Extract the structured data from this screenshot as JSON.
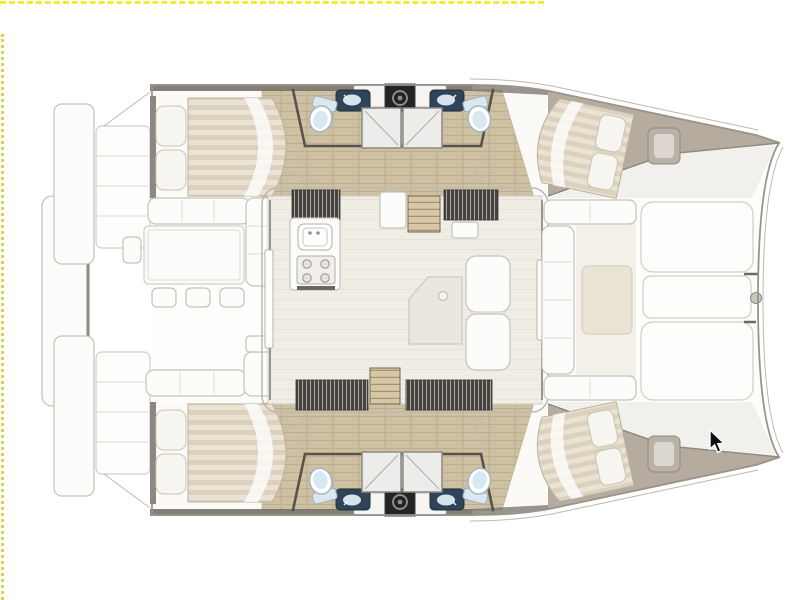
{
  "view": {
    "description": "top-down catamaran yacht deck and accommodation plan",
    "hulls": 2,
    "double_beds": 4,
    "shower_cubicles": 4,
    "toilets": 4,
    "bathroom_sinks": 4,
    "areas": [
      "aft-swim-platforms",
      "aft-cockpit-dining",
      "salon",
      "galley",
      "companionway-stairs",
      "hull-bathrooms",
      "aft-cabins",
      "forward-cabins",
      "forward-cockpit",
      "foredeck-sunpads",
      "bow"
    ]
  },
  "guides": {
    "top": {
      "x1": 0,
      "x2": 544,
      "y": 1
    },
    "left": {
      "x": 1,
      "y1": 34,
      "y2": 600
    }
  },
  "cursor": {
    "x": 708,
    "y": 429
  },
  "colors": {
    "background": "#ffffff",
    "guide_top": "#f3e93a",
    "guide_left": "#d8d44b",
    "hull_stroke": "#9a9389",
    "roof_stroke": "#bdb9b1",
    "deck_fill": "#fdfdfc",
    "hull_inner_fill": "#fbfaf7",
    "gunwale": "#6e6961",
    "bow_deck": "#b5ab9e",
    "glass": "#f1f0ec",
    "wood": "#cec0a3",
    "wood_line": "#bdae8e",
    "salon_floor": "#f0ede4",
    "salon_floor_line": "#e6e2d7",
    "cabinet": "#46433e",
    "cabinet_slat": "#d8d5cf",
    "stairs": "#d7c7a6",
    "stairs_line": "#a49370",
    "mattress": "#eae3d3",
    "mattress_stripe": "#dbd1bc",
    "pillow": "#f7f5ef",
    "furniture_fill": "#fcfcfa",
    "furniture_stroke": "#c6c2ba",
    "wall_dark": "#57534c",
    "sink_navy": "#2f4458",
    "basin_blue": "#d7e3ec",
    "toilet_blue": "#d9e7f1",
    "toilet_stroke": "#9fb3c2",
    "shower_fill": "#ececea",
    "shower_stroke": "#8f8b84",
    "appliance": "#232326",
    "appliance_ring": "#8b8b90",
    "cursor_fill": "#111111",
    "cursor_outline": "#ffffff"
  }
}
